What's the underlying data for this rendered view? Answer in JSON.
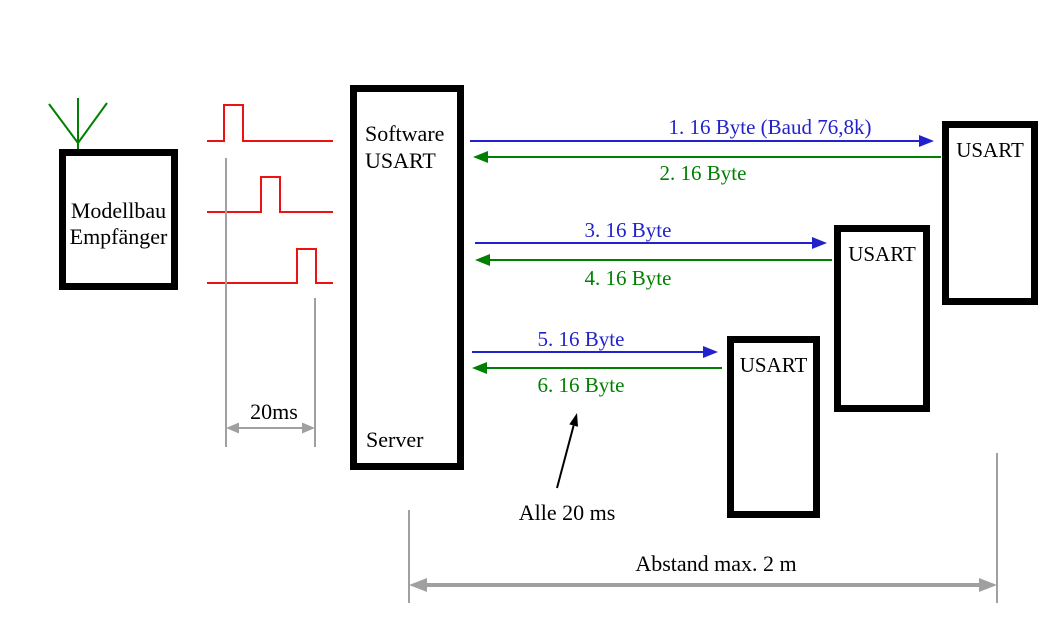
{
  "colors": {
    "blue": "#2222CC",
    "green": "#008000",
    "red": "#EE1111",
    "gray": "#A0A0A0",
    "black": "#000000"
  },
  "receiver": {
    "line1": "Modellbau",
    "line2": "Empfänger"
  },
  "server": {
    "line1": "Software",
    "line2": "USART",
    "line3": "Server"
  },
  "usarts": [
    {
      "label": "USART"
    },
    {
      "label": "USART"
    },
    {
      "label": "USART"
    }
  ],
  "messages": [
    {
      "label": "1. 16 Byte (Baud 76,8k)",
      "direction": "right",
      "color": "blue"
    },
    {
      "label": "2. 16 Byte",
      "direction": "left",
      "color": "green"
    },
    {
      "label": "3. 16 Byte",
      "direction": "right",
      "color": "blue"
    },
    {
      "label": "4. 16 Byte",
      "direction": "left",
      "color": "green"
    },
    {
      "label": "5. 16 Byte",
      "direction": "right",
      "color": "blue"
    },
    {
      "label": "6. 16 Byte",
      "direction": "left",
      "color": "green"
    }
  ],
  "annotations": {
    "pulse_interval": "20ms",
    "cycle": "Alle 20 ms",
    "distance": "Abstand max. 2 m"
  }
}
